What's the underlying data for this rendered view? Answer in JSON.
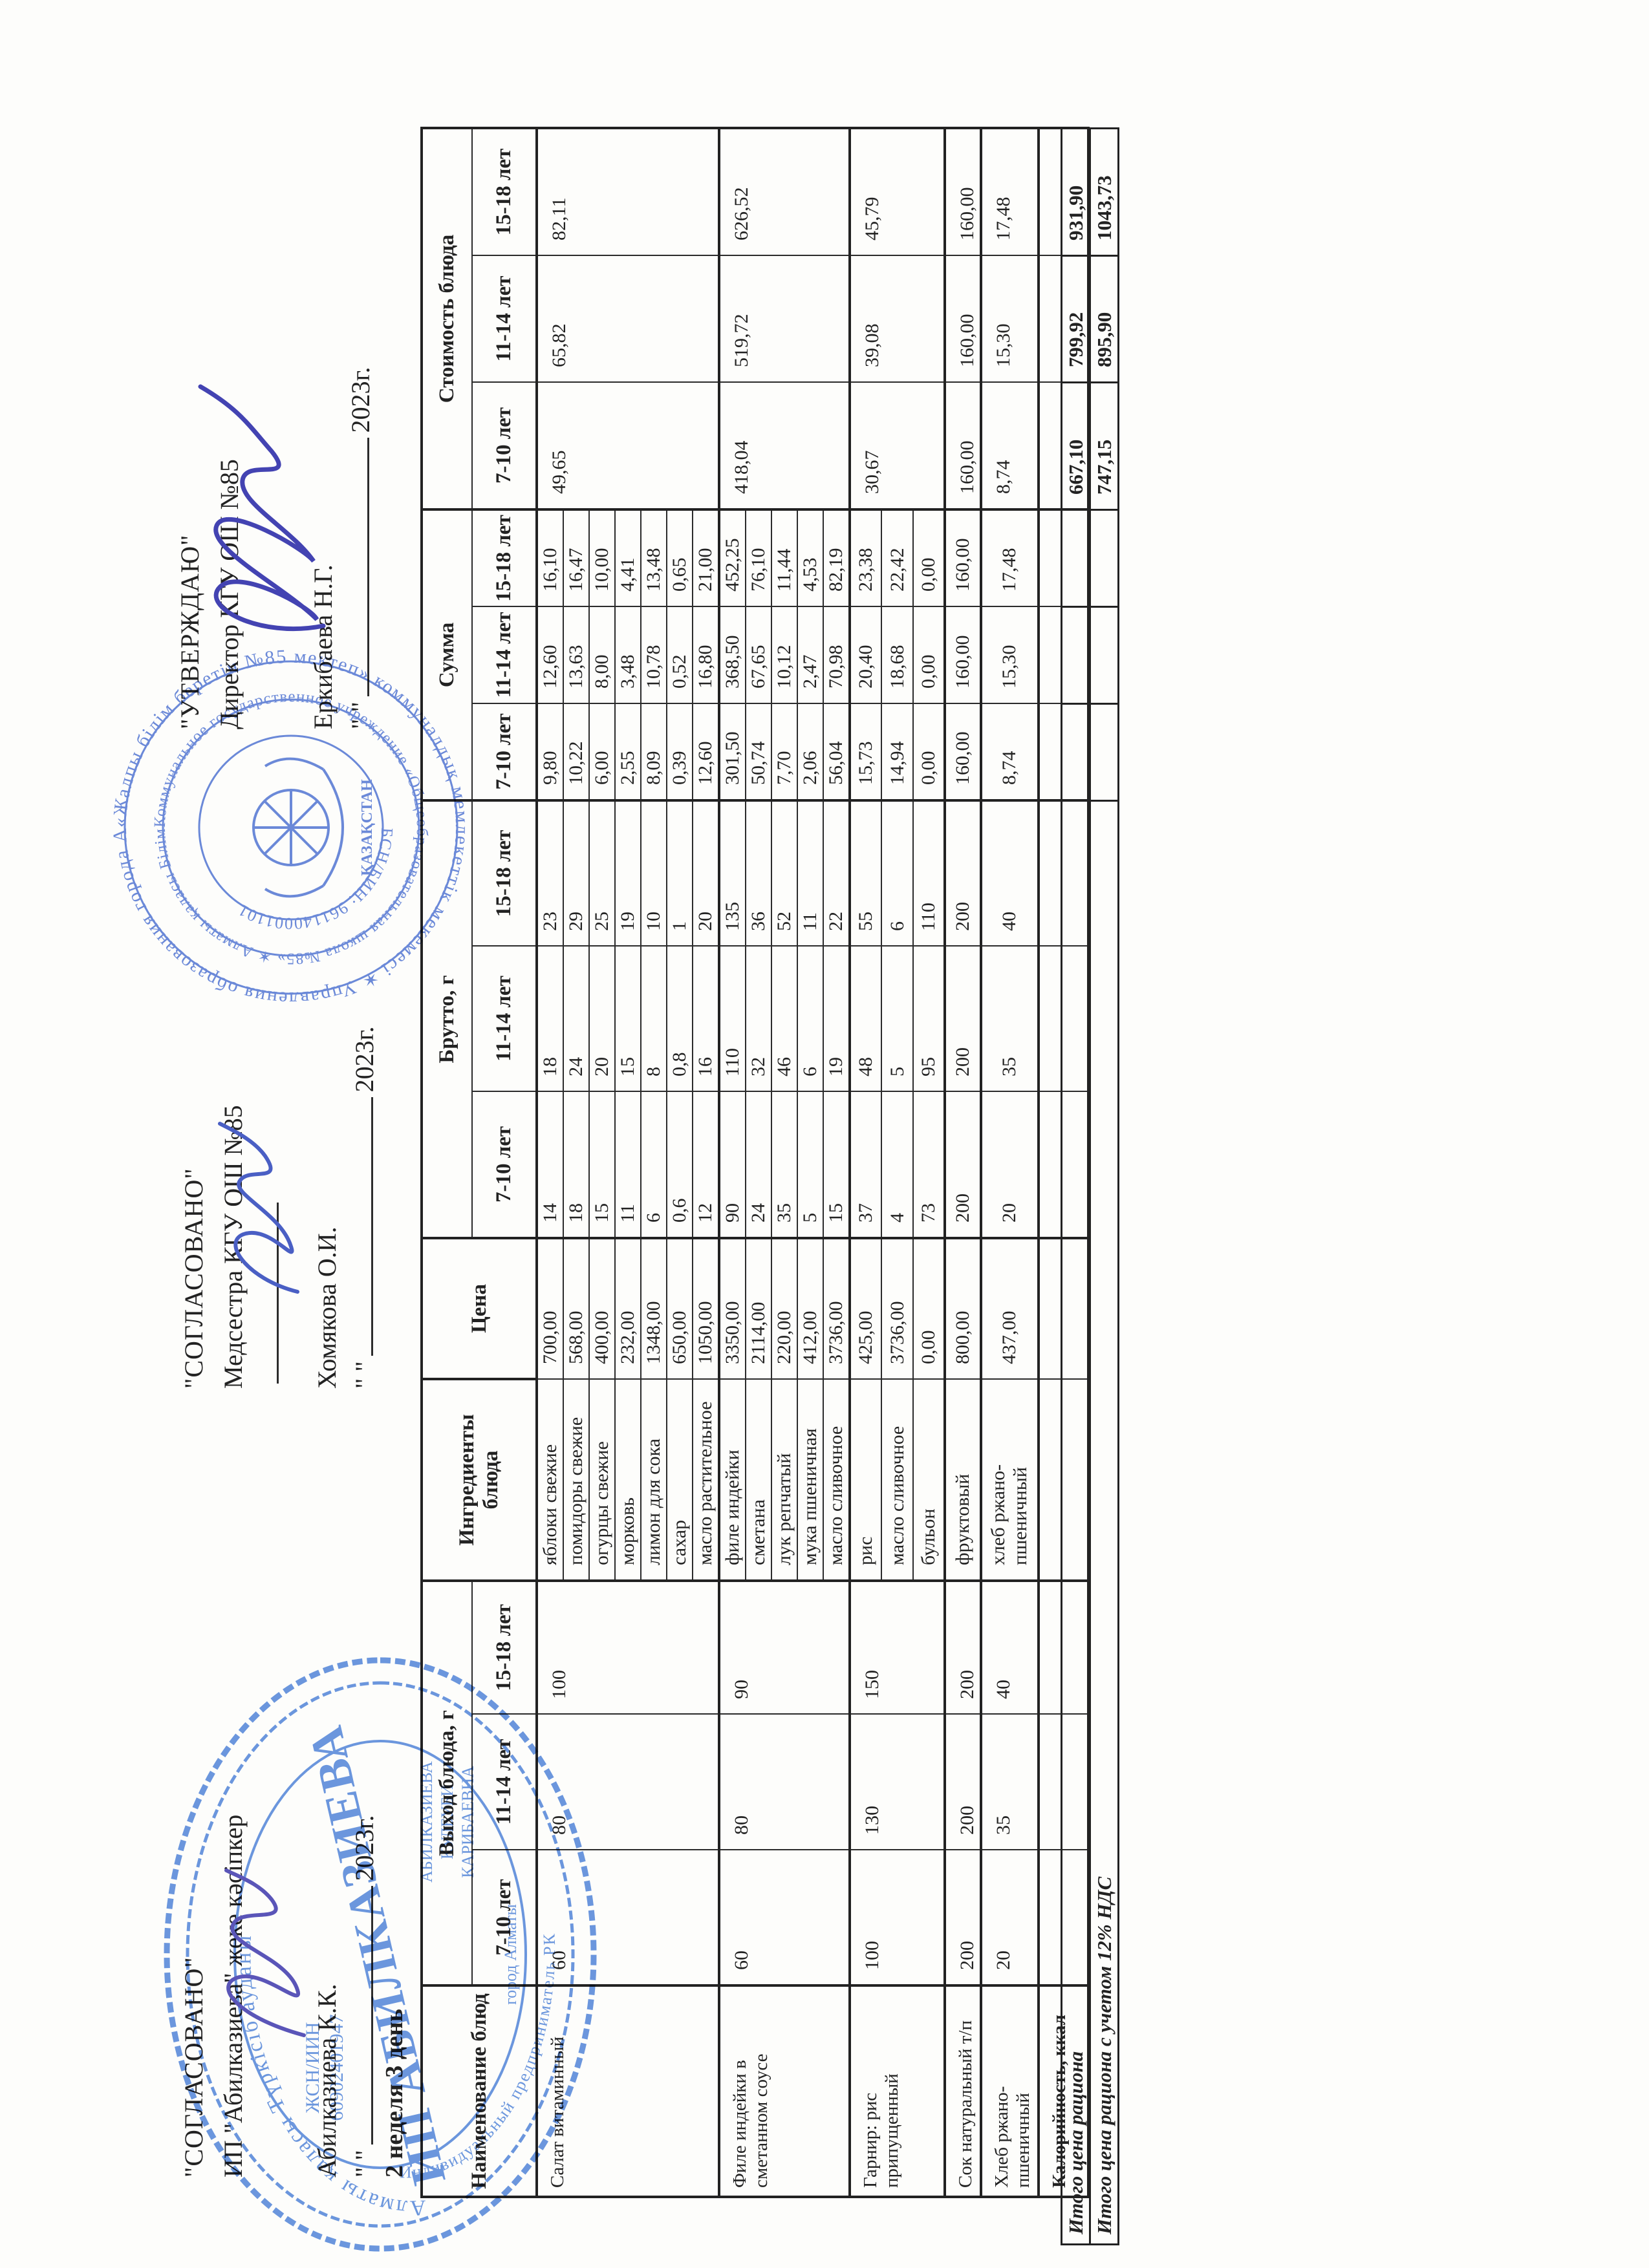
{
  "page": {
    "week_label": "2 неделя 3 день",
    "year": "2023г.",
    "quotes": "\"      \""
  },
  "approvals": {
    "ip": {
      "title": "\"СОГЛАСОВАНО\"",
      "role": "ИП \"Абилказиева\" жеке кәсіпкер",
      "name": "Абилказиева К.К."
    },
    "med": {
      "title": "\"СОГЛАСОВАНО\"",
      "role": "Медсестра КГУ ОШ №85",
      "name": "Хомякова О.И."
    },
    "dir": {
      "title": "\"УТВЕРЖДАЮ\"",
      "role": "Директор КГУ ОШ №85",
      "name": "Еркибаева Н.Г."
    }
  },
  "table": {
    "headers": {
      "dish": "Наименование блюд",
      "yield": "Выход блюда, г",
      "ingredients": "Ингредиенты блюда",
      "price": "Цена",
      "brutto": "Брутто, г",
      "sum": "Сумма",
      "cost": "Стоимость блюда",
      "ages": [
        "7-10 лет",
        "11-14 лет",
        "15-18 лет"
      ]
    },
    "groups": [
      {
        "name": "Салат витаминный",
        "yield": [
          "60",
          "80",
          "100"
        ],
        "cost": [
          "49,65",
          "65,82",
          "82,11"
        ],
        "rows": [
          [
            "яблоки свежие",
            "700,00",
            "14",
            "18",
            "23",
            "9,80",
            "12,60",
            "16,10"
          ],
          [
            "помидоры свежие",
            "568,00",
            "18",
            "24",
            "29",
            "10,22",
            "13,63",
            "16,47"
          ],
          [
            "огурцы свежие",
            "400,00",
            "15",
            "20",
            "25",
            "6,00",
            "8,00",
            "10,00"
          ],
          [
            "морковь",
            "232,00",
            "11",
            "15",
            "19",
            "2,55",
            "3,48",
            "4,41"
          ],
          [
            "лимон для сока",
            "1348,00",
            "6",
            "8",
            "10",
            "8,09",
            "10,78",
            "13,48"
          ],
          [
            "сахар",
            "650,00",
            "0,6",
            "0,8",
            "1",
            "0,39",
            "0,52",
            "0,65"
          ],
          [
            "масло растительное",
            "1050,00",
            "12",
            "16",
            "20",
            "12,60",
            "16,80",
            "21,00"
          ]
        ]
      },
      {
        "name": "Филе индейки в сметанном соусе",
        "yield": [
          "60",
          "80",
          "90"
        ],
        "cost": [
          "418,04",
          "519,72",
          "626,52"
        ],
        "rows": [
          [
            "филе индейки",
            "3350,00",
            "90",
            "110",
            "135",
            "301,50",
            "368,50",
            "452,25"
          ],
          [
            "сметана",
            "2114,00",
            "24",
            "32",
            "36",
            "50,74",
            "67,65",
            "76,10"
          ],
          [
            "лук репчатый",
            "220,00",
            "35",
            "46",
            "52",
            "7,70",
            "10,12",
            "11,44"
          ],
          [
            "мука пшеничная",
            "412,00",
            "5",
            "6",
            "11",
            "2,06",
            "2,47",
            "4,53"
          ],
          [
            "масло сливочное",
            "3736,00",
            "15",
            "19",
            "22",
            "56,04",
            "70,98",
            "82,19"
          ]
        ]
      },
      {
        "name": "Гарнир: рис припущенный",
        "yield": [
          "100",
          "130",
          "150"
        ],
        "cost": [
          "30,67",
          "39,08",
          "45,79"
        ],
        "rows": [
          [
            "рис",
            "425,00",
            "37",
            "48",
            "55",
            "15,73",
            "20,40",
            "23,38"
          ],
          [
            "масло сливочное",
            "3736,00",
            "4",
            "5",
            "6",
            "14,94",
            "18,68",
            "22,42"
          ],
          [
            "бульон",
            "0,00",
            "73",
            "95",
            "110",
            "0,00",
            "0,00",
            "0,00"
          ]
        ]
      },
      {
        "name": "Сок натуральный т/п",
        "yield": [
          "200",
          "200",
          "200"
        ],
        "cost": [
          "160,00",
          "160,00",
          "160,00"
        ],
        "rows": [
          [
            "фруктовый",
            "800,00",
            "200",
            "200",
            "200",
            "160,00",
            "160,00",
            "160,00"
          ]
        ]
      },
      {
        "name": "Хлеб ржано-пшеничный",
        "yield": [
          "20",
          "35",
          "40"
        ],
        "cost": [
          "8,74",
          "15,30",
          "17,48"
        ],
        "rows": [
          [
            "хлеб ржано-пшеничный",
            "437,00",
            "20",
            "35",
            "40",
            "8,74",
            "15,30",
            "17,48"
          ]
        ]
      },
      {
        "name": "Калорийность, ккал",
        "bold": true,
        "yield": [
          "",
          "",
          ""
        ],
        "cost": [
          "",
          "",
          ""
        ],
        "rows": [
          [
            "",
            "",
            "",
            "",
            "",
            "",
            "",
            ""
          ]
        ]
      }
    ],
    "totals": [
      {
        "label": "Итого цена рациона",
        "values": [
          "667,10",
          "799,92",
          "931,90"
        ]
      },
      {
        "label": "Итого цена рациона с учетом 12% НДС",
        "values": [
          "747,15",
          "895,90",
          "1043,73"
        ]
      }
    ]
  },
  "stamps": {
    "round": {
      "outer": "«Жалпы білім беретін №85 мектеп» коммуналдық мемлекеттік мекемесі ✶ Управления образования города Алматы ✶",
      "mid": "Коммунальное государственное учреждение «Общеобразовательная школа №85» ✶ Алматы қаласы Білім басқармасының ✶",
      "inner": "БСН/БИН: 961140001101",
      "emblem": "ҚАЗАҚСТАН"
    },
    "oval": {
      "top": "Алматы қаласы Түркісіб ауданы",
      "bottom": "Индивидуальный предприниматель РК",
      "big": "ИП АБИЛКАЗИЕВА",
      "idn1": "ЖСН/ИИН",
      "idn2": "60902401947",
      "fio1": "АБИЛКАЗИЕВА",
      "fio2": "КУЛБУБИ",
      "fio3": "КАРИБАЕВНА",
      "city": "город Алматы"
    }
  },
  "colors": {
    "stamp_blue": "#4a6fd0",
    "signature_blue": "#4343b2",
    "ink": "#222222"
  }
}
